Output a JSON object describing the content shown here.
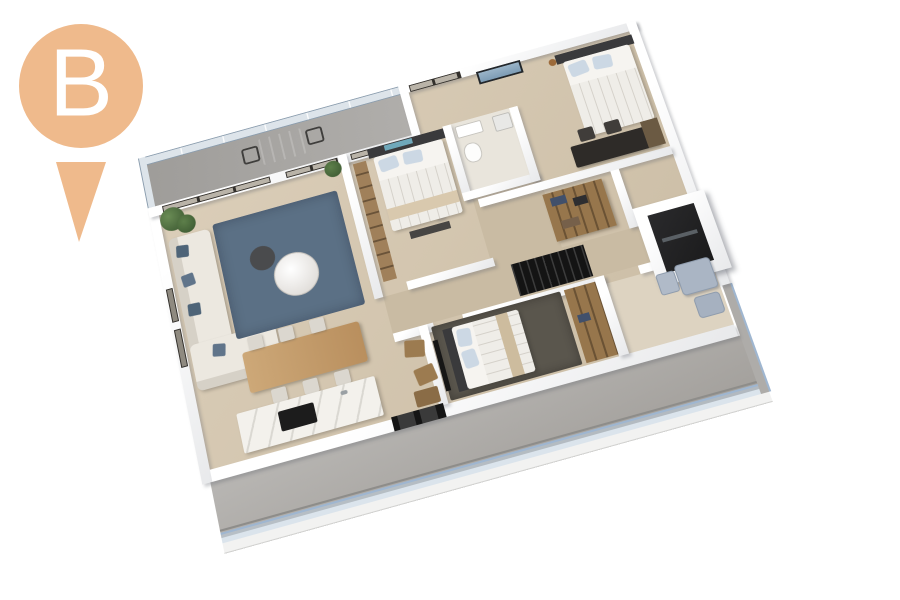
{
  "marker": {
    "label": "B"
  },
  "colors": {
    "pin": "#efba8c",
    "pinlabel": "#ffffff",
    "wood": "#d6c9b3",
    "woodDark": "#c9bba3",
    "bathFloor": "#e9e5dc",
    "balcony": "#aba9a6",
    "balconyLow": "#b4b2af",
    "glass": "#dde4ea",
    "glassFrame": "#8b9dae",
    "railBlue": "#9fb6d0",
    "darkFrame": "#33302c",
    "doorGlass": "#b9b3a8",
    "rugBlue": "#5b7085",
    "rugDark": "#5a564d",
    "sofa": "#ece8e0",
    "pillowBlue": "#4e6478",
    "linen": "#f6f4f0",
    "duvet": "#efede8",
    "pillowLight": "#ccd8e4",
    "headboard": "#3a3a3c",
    "tealAccent": "#6fa8ba",
    "throwBeige": "#d9c9ae",
    "tableWood": "#c79f6f",
    "wardrobe": "#97764c",
    "chairGray": "#dbd7cf",
    "island": "#f3f1ec",
    "cooktop": "#1c1c1c",
    "fixture": "#aab5c4",
    "fixtureEdge": "#8f9cad",
    "plant": "#4c6b3f",
    "plantDark": "#39552f",
    "void": "#141414",
    "shaftIn": "#1b1b1c",
    "deskDark": "#2e2b28",
    "artBlue": "#7d9cb5"
  }
}
